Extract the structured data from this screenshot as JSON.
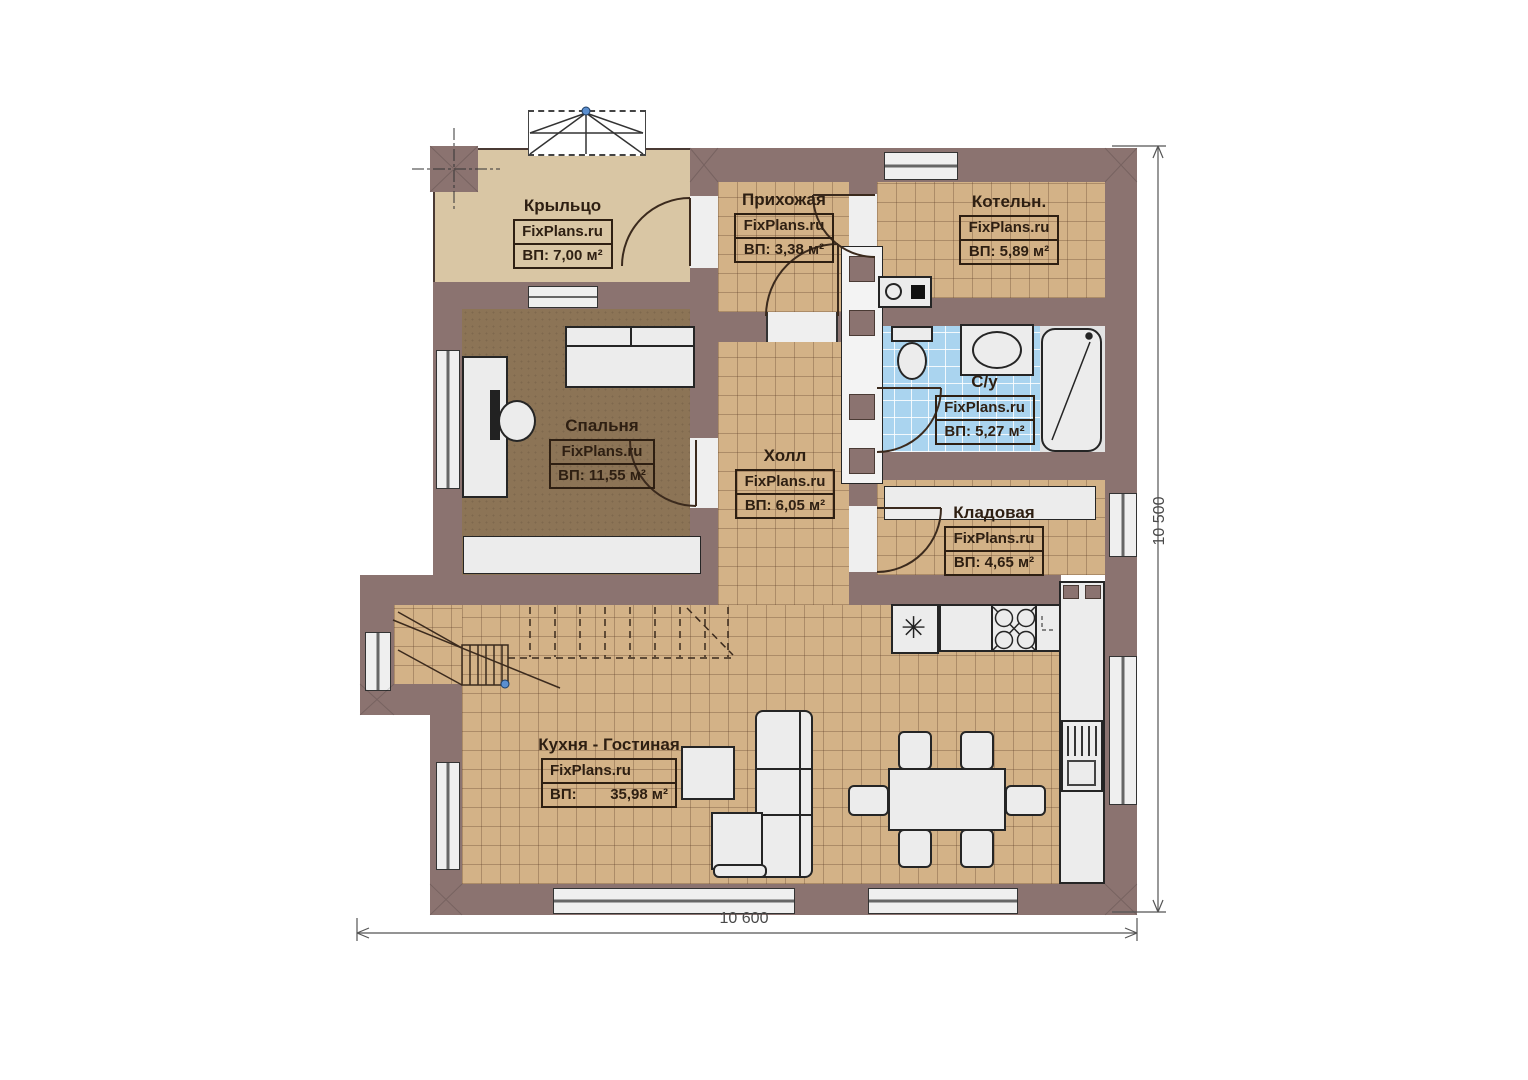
{
  "watermark": "FixPlans.ru",
  "rooms": {
    "porch": {
      "name": "Крыльцо",
      "area_label": "ВП: 7,00 м²"
    },
    "entry": {
      "name": "Прихожая",
      "area_label": "ВП: 3,38 м²"
    },
    "boiler": {
      "name": "Котельн.",
      "area_label": "ВП: 5,89 м²"
    },
    "bedroom": {
      "name": "Спальня",
      "area_label": "ВП: 11,55 м²"
    },
    "hall": {
      "name": "Холл",
      "area_label": "ВП: 6,05 м²"
    },
    "bathroom": {
      "name": "С/у",
      "area_label": "ВП: 5,27 м²"
    },
    "storage": {
      "name": "Кладовая",
      "area_label": "ВП: 4,65 м²"
    },
    "kitchen_living": {
      "name": "Кухня - Гостиная",
      "area_prefix": "ВП:",
      "area_value": "35,98 м²"
    }
  },
  "dimensions": {
    "bottom_width": "10 600",
    "right_height": "10 500"
  },
  "icons": {
    "sink_symbol": "✳"
  },
  "colors": {
    "wall": "#8b7370",
    "floor_tile": "#d3b287",
    "porch_floor": "#d9c6a4",
    "bedroom_floor": "#8c7456",
    "bathroom_tile": "#aad4ef",
    "marker_dot": "#5b8fd0"
  }
}
